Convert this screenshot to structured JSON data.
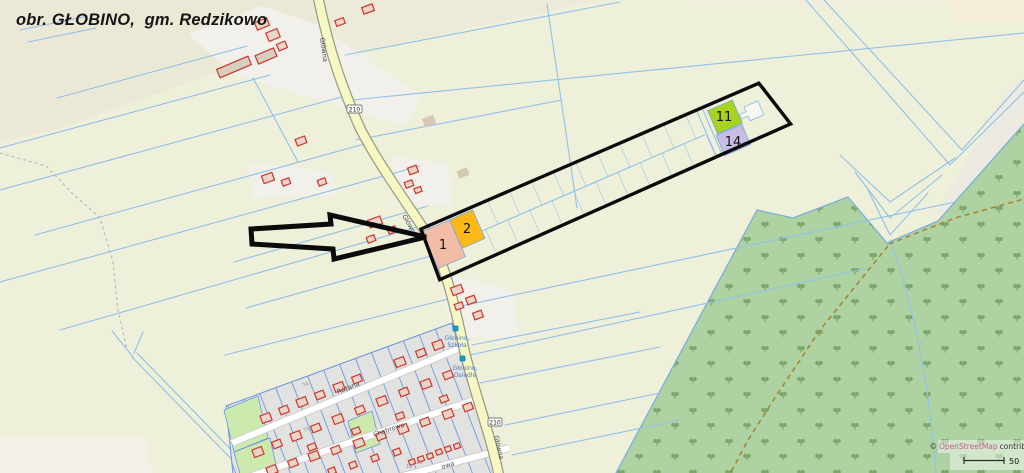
{
  "title": "obr. GŁOBINO,  gm. Redzikowo",
  "colors": {
    "parcel_1": "#f3bca6",
    "parcel_2": "#fcb817",
    "parcel_11": "#a8d41f",
    "parcel_14": "#c9bde5",
    "annotation": "#0b0b0b",
    "osm_link": "#c45c8f"
  },
  "map": {
    "road": {
      "name": "Główna",
      "ref": "210"
    },
    "streets": [
      {
        "name": "Różana"
      },
      {
        "name": "Chabrowa"
      },
      {
        "name": "owa"
      }
    ],
    "bus_stops": [
      {
        "line1": "Głobino,",
        "line2": "Szkoła"
      },
      {
        "line1": "Głobino,",
        "line2": "Osiedle"
      }
    ],
    "parcels": {
      "p1": {
        "id": "1"
      },
      "p2": {
        "id": "2"
      },
      "p11": {
        "id": "11"
      },
      "p14": {
        "id": "14"
      }
    },
    "plot_numbers": [
      "74",
      "75",
      "18",
      "16"
    ],
    "buildings": [
      [
        234,
        67,
        34,
        9,
        -23,
        "f"
      ],
      [
        262,
        24,
        13,
        8,
        -23,
        "r"
      ],
      [
        273,
        35,
        12,
        9,
        -23,
        "r"
      ],
      [
        266,
        56,
        20,
        9,
        -23,
        "f"
      ],
      [
        282,
        46,
        9,
        7,
        -23,
        "r"
      ],
      [
        368,
        9,
        11,
        7,
        -20,
        "r"
      ],
      [
        340,
        22,
        9,
        6,
        -20,
        "r"
      ],
      [
        301,
        141,
        10,
        7,
        -20,
        "r"
      ],
      [
        268,
        178,
        11,
        8,
        -20,
        "r"
      ],
      [
        286,
        182,
        8,
        6,
        -20,
        "r"
      ],
      [
        322,
        182,
        8,
        6,
        -20,
        "r"
      ],
      [
        413,
        170,
        9,
        7,
        -20,
        "r"
      ],
      [
        409,
        184,
        8,
        6,
        -20,
        "r"
      ],
      [
        418,
        190,
        7,
        5,
        -20,
        "r"
      ],
      [
        375,
        222,
        13,
        8,
        -20,
        "r"
      ],
      [
        392,
        230,
        8,
        6,
        -20,
        "r"
      ],
      [
        371,
        239,
        8,
        6,
        -20,
        "r"
      ],
      [
        457,
        290,
        11,
        8,
        -20,
        "r"
      ],
      [
        471,
        300,
        9,
        7,
        -20,
        "r"
      ],
      [
        459,
        306,
        8,
        6,
        -20,
        "r"
      ],
      [
        478,
        315,
        9,
        7,
        -20,
        "r"
      ],
      [
        429,
        121,
        12,
        9,
        -20,
        "t"
      ],
      [
        463,
        173,
        11,
        8,
        -20,
        "t"
      ],
      [
        266,
        418,
        10,
        8,
        -21,
        "r"
      ],
      [
        284,
        410,
        9,
        7,
        -21,
        "r"
      ],
      [
        302,
        402,
        10,
        8,
        -21,
        "r"
      ],
      [
        320,
        395,
        9,
        7,
        -21,
        "r"
      ],
      [
        339,
        387,
        10,
        8,
        -21,
        "r"
      ],
      [
        357,
        379,
        9,
        7,
        -21,
        "r"
      ],
      [
        400,
        362,
        10,
        8,
        -21,
        "r"
      ],
      [
        421,
        353,
        9,
        7,
        -21,
        "r"
      ],
      [
        438,
        345,
        10,
        8,
        -21,
        "r"
      ],
      [
        258,
        452,
        10,
        8,
        -21,
        "r"
      ],
      [
        277,
        444,
        9,
        7,
        -21,
        "r"
      ],
      [
        296,
        436,
        10,
        8,
        -21,
        "r"
      ],
      [
        316,
        428,
        9,
        7,
        -21,
        "r"
      ],
      [
        338,
        419,
        10,
        8,
        -21,
        "r"
      ],
      [
        360,
        410,
        9,
        7,
        -21,
        "r"
      ],
      [
        382,
        401,
        10,
        8,
        -21,
        "r"
      ],
      [
        404,
        392,
        9,
        7,
        -21,
        "r"
      ],
      [
        426,
        384,
        10,
        8,
        -21,
        "r"
      ],
      [
        448,
        375,
        9,
        7,
        -21,
        "r"
      ],
      [
        312,
        447,
        8,
        6,
        -21,
        "r"
      ],
      [
        356,
        431,
        8,
        6,
        -21,
        "r"
      ],
      [
        400,
        416,
        8,
        6,
        -21,
        "r"
      ],
      [
        444,
        399,
        8,
        6,
        -21,
        "r"
      ],
      [
        272,
        470,
        10,
        8,
        -21,
        "r"
      ],
      [
        293,
        463,
        9,
        7,
        -21,
        "r"
      ],
      [
        314,
        456,
        10,
        8,
        -21,
        "r"
      ],
      [
        336,
        450,
        9,
        7,
        -21,
        "r"
      ],
      [
        359,
        443,
        10,
        8,
        -21,
        "r"
      ],
      [
        381,
        436,
        9,
        7,
        -21,
        "r"
      ],
      [
        403,
        429,
        10,
        8,
        -21,
        "r"
      ],
      [
        425,
        422,
        9,
        7,
        -21,
        "r"
      ],
      [
        448,
        414,
        10,
        8,
        -21,
        "r"
      ],
      [
        468,
        407,
        9,
        7,
        -21,
        "r"
      ],
      [
        412,
        462,
        6,
        5,
        -21,
        "r"
      ],
      [
        421,
        459,
        6,
        5,
        -21,
        "r"
      ],
      [
        430,
        456,
        6,
        5,
        -21,
        "r"
      ],
      [
        439,
        452,
        6,
        5,
        -21,
        "r"
      ],
      [
        448,
        449,
        6,
        5,
        -21,
        "r"
      ],
      [
        457,
        446,
        6,
        5,
        -21,
        "r"
      ],
      [
        332,
        471,
        7,
        6,
        -21,
        "r"
      ],
      [
        353,
        465,
        7,
        6,
        -21,
        "r"
      ],
      [
        375,
        458,
        7,
        6,
        -21,
        "r"
      ],
      [
        397,
        452,
        7,
        6,
        -21,
        "r"
      ]
    ],
    "drains": [
      "0,148 270,75",
      "0,190 345,96",
      "35,235 368,143",
      "0,282 420,166",
      "60,330 428,224",
      "253,78 298,162",
      "20,30 88,16",
      "28,42 96,28",
      "57,98 247,46",
      "345,55 620,2",
      "352,100 1024,33",
      "356,140 562,100",
      "547,4 577,208",
      "234,262 428,206",
      "246,308 445,252",
      "225,355 452,298",
      "452,308 955,202",
      "470,355 868,268",
      "505,425 660,393",
      "512,455 680,420",
      "480,383 660,347",
      "472,345 640,312",
      "806,0 950,165 1024,92",
      "824,0 962,150 1024,80",
      "840,155 890,202 955,158",
      "855,172 890,218 942,175",
      "868,190 890,235 928,193",
      "890,240 902,275 916,330 927,390 933,440 936,473",
      "132,357 242,470",
      "137,353 247,466",
      "112,331 133,357",
      "143,332 134,353",
      "244,462 470,373"
    ]
  },
  "footer": {
    "copyright": "©",
    "osm": "OpenStreetMap",
    "suffix": "contrib",
    "scale": "50"
  }
}
